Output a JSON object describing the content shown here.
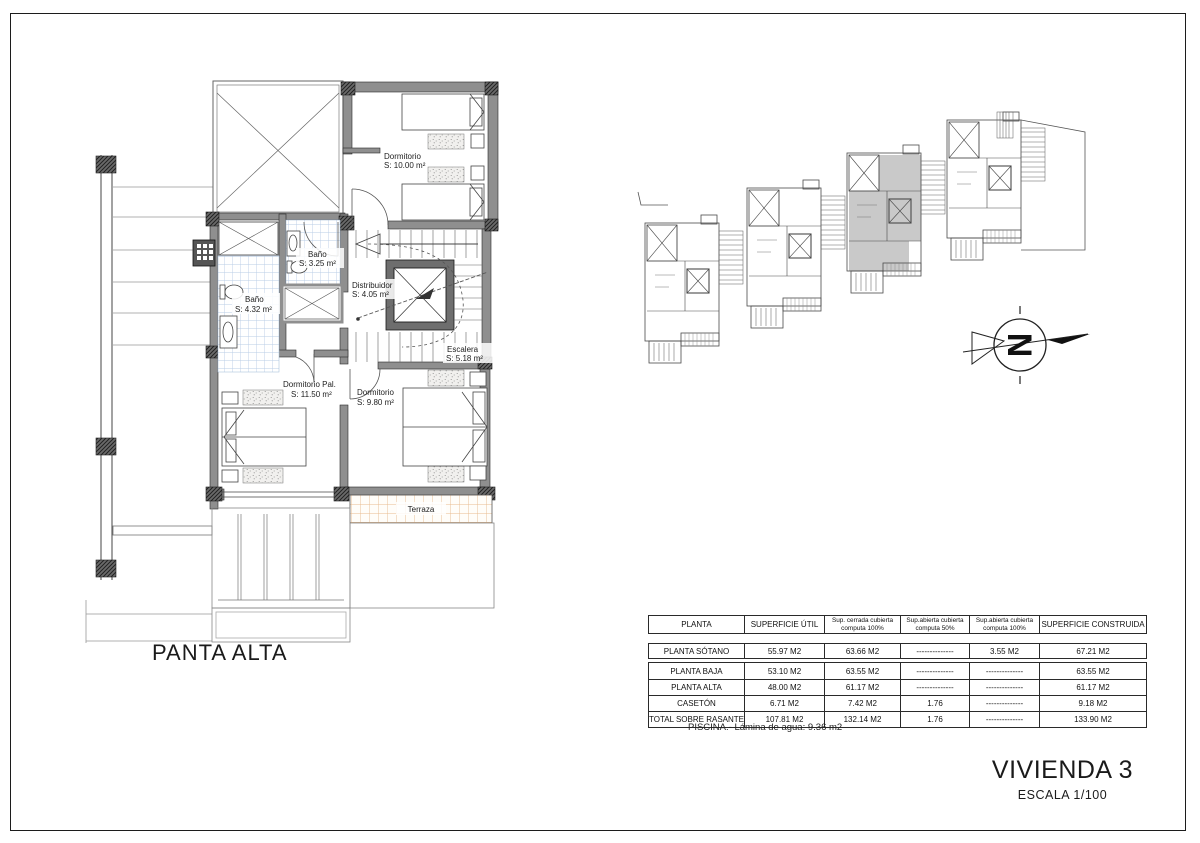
{
  "sheet": {
    "plan_label": "PANTA ALTA",
    "title": "VIVIENDA 3",
    "scale": "ESCALA 1/100"
  },
  "plan_rooms": {
    "dormitorio_top": {
      "name": "Dormitorio",
      "area": "S: 10.00 m²"
    },
    "bano_small": {
      "name": "Baño",
      "area": "S: 3.25 m²"
    },
    "bano_large": {
      "name": "Baño",
      "area": "S: 4.32 m²"
    },
    "distribuidor": {
      "name": "Distribuidor",
      "area": "S: 4.05 m²"
    },
    "escalera": {
      "name": "Escalera",
      "area": "S: 5.18 m²"
    },
    "dormitorio_pal": {
      "name": "Dormitorio Pal.",
      "area": "S: 11.50 m²"
    },
    "dormitorio_back": {
      "name": "Dormitorio",
      "area": "S: 9.80 m²"
    },
    "terraza": {
      "name": "Terraza"
    }
  },
  "north_arrow": {
    "letter": "N"
  },
  "colors": {
    "wall_gray": "#8f8f8f",
    "highlighted_unit": "#c9c9c9",
    "bath_tile": "#b9cde6",
    "terrace_tile": "#e8bb8f"
  },
  "areas_table": {
    "headers": [
      "PLANTA",
      "SUPERFICIE ÚTIL",
      "Sup. cerrada cubierta\ncomputa 100%",
      "Sup.abierta cubierta\ncomputa 50%",
      "Sup.abierta cubierta\ncomputa 100%",
      "SUPERFICIE CONSTRUIDA"
    ],
    "rows": [
      [
        "PLANTA SÓTANO",
        "55.97 M2",
        "63.66 M2",
        "--------------",
        "3.55 M2",
        "67.21 M2"
      ],
      [
        "PLANTA BAJA",
        "53.10 M2",
        "63.55 M2",
        "--------------",
        "--------------",
        "63.55 M2"
      ],
      [
        "PLANTA ALTA",
        "48.00 M2",
        "61.17 M2",
        "--------------",
        "--------------",
        "61.17 M2"
      ],
      [
        "CASETÓN",
        "6.71 M2",
        "7.42 M2",
        "1.76",
        "--------------",
        "9.18 M2"
      ],
      [
        "TOTAL SOBRE RASANTE",
        "107.81 M2",
        "132.14 M2",
        "1.76",
        "--------------",
        "133.90 M2"
      ]
    ],
    "footnote": "PISCINA.- Lámina de agua: 9.36 m2"
  }
}
